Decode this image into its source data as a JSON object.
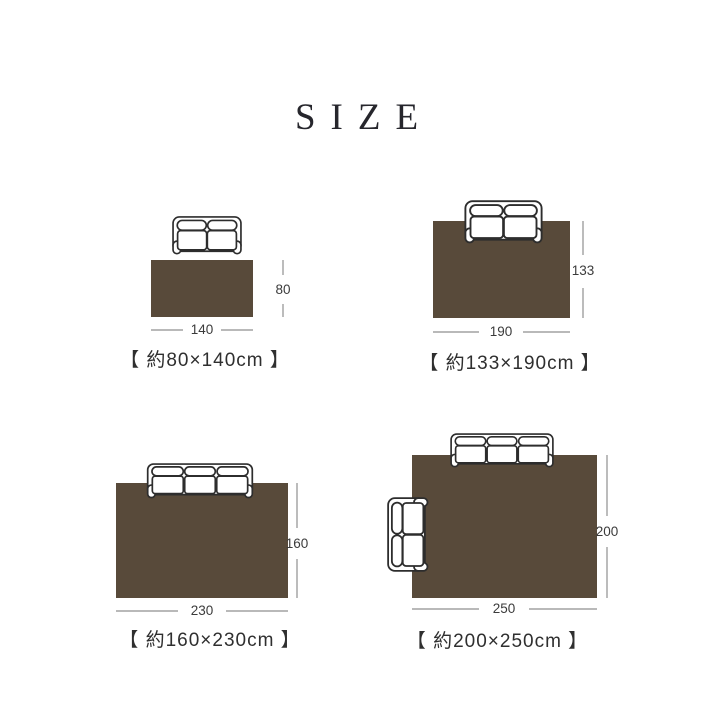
{
  "title": "SIZE",
  "colors": {
    "background": "#ffffff",
    "rug": "#584a3a",
    "sofa_outline": "#2d2d2d",
    "sofa_fill": "#ffffff",
    "dimension_line": "#8f8f8f",
    "dimension_text": "#3b3b3b",
    "caption_text": "#2f2f2f",
    "title_text": "#26262c"
  },
  "panels": [
    {
      "id": "80x140",
      "caption": "【 約80×140cm 】",
      "height_cm": "80",
      "width_cm": "140",
      "sofas": [
        "two-seat sofa (top view)"
      ]
    },
    {
      "id": "133x190",
      "caption": "【 約133×190cm 】",
      "height_cm": "133",
      "width_cm": "190",
      "sofas": [
        "two-seat sofa (top view)"
      ]
    },
    {
      "id": "160x230",
      "caption": "【 約160×230cm 】",
      "height_cm": "160",
      "width_cm": "230",
      "sofas": [
        "three-seat sofa (top view)"
      ]
    },
    {
      "id": "200x250",
      "caption": "【 約200×250cm 】",
      "height_cm": "200",
      "width_cm": "250",
      "sofas": [
        "three-seat sofa (top view)",
        "two-seat sofa (side placement, top view)"
      ]
    }
  ]
}
